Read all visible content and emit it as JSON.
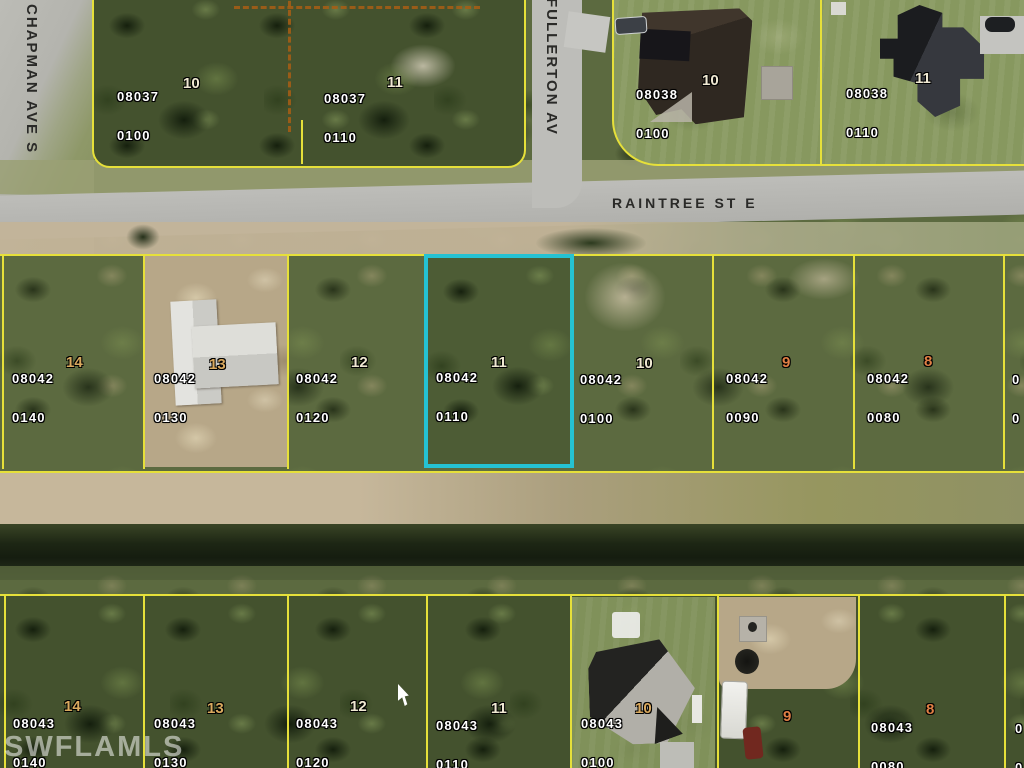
{
  "map": {
    "watermark": "SWFLAMLS",
    "streets": {
      "raintree": "RAINTREE ST E",
      "chapman": "CHAPMAN AVE S",
      "fullerton": "FULLERTON AV"
    },
    "colors": {
      "parcel_boundary_yellow": "#e6e03a",
      "highlight_outline_cyan": "#25c2d3",
      "plat_dashed_orange": "#a85e14",
      "lot_number_cream": "#efe8d2",
      "lot_number_tan": "#d9a95e",
      "lot_number_orange": "#e07f45"
    },
    "highlighted_parcel": {
      "book": "08042",
      "parcel": "0110",
      "lot": "11"
    },
    "blocks": {
      "top_left": [
        {
          "book": "08037",
          "parcel": "0100",
          "lot": "10"
        },
        {
          "book": "08037",
          "parcel": "0110",
          "lot": "11"
        }
      ],
      "top_right": [
        {
          "book": "08038",
          "parcel": "0100",
          "lot": "10"
        },
        {
          "book": "08038",
          "parcel": "0110",
          "lot": "11"
        }
      ],
      "middle_row": [
        {
          "book": "08042",
          "parcel": "0140",
          "lot": "14"
        },
        {
          "book": "08042",
          "parcel": "0130",
          "lot": "13"
        },
        {
          "book": "08042",
          "parcel": "0120",
          "lot": "12"
        },
        {
          "book": "08042",
          "parcel": "0110",
          "lot": "11"
        },
        {
          "book": "08042",
          "parcel": "0100",
          "lot": "10"
        },
        {
          "book": "08042",
          "parcel": "0090",
          "lot": "9"
        },
        {
          "book": "08042",
          "parcel": "0080",
          "lot": "8"
        }
      ],
      "middle_row_edge_partial": {
        "line1": "0",
        "line2": "0"
      },
      "bottom_row": [
        {
          "book": "08043",
          "parcel": "0140",
          "lot": "14"
        },
        {
          "book": "08043",
          "parcel": "0130",
          "lot": "13"
        },
        {
          "book": "08043",
          "parcel": "0120",
          "lot": "12"
        },
        {
          "book": "08043",
          "parcel": "0110",
          "lot": "11"
        },
        {
          "book": "08043",
          "parcel": "0100",
          "lot": "10"
        },
        {
          "lot": "9"
        },
        {
          "book": "08043",
          "parcel": "0080",
          "lot": "8"
        }
      ],
      "bottom_row_edge_partial": {
        "line1": "0",
        "line2": "0"
      }
    }
  }
}
